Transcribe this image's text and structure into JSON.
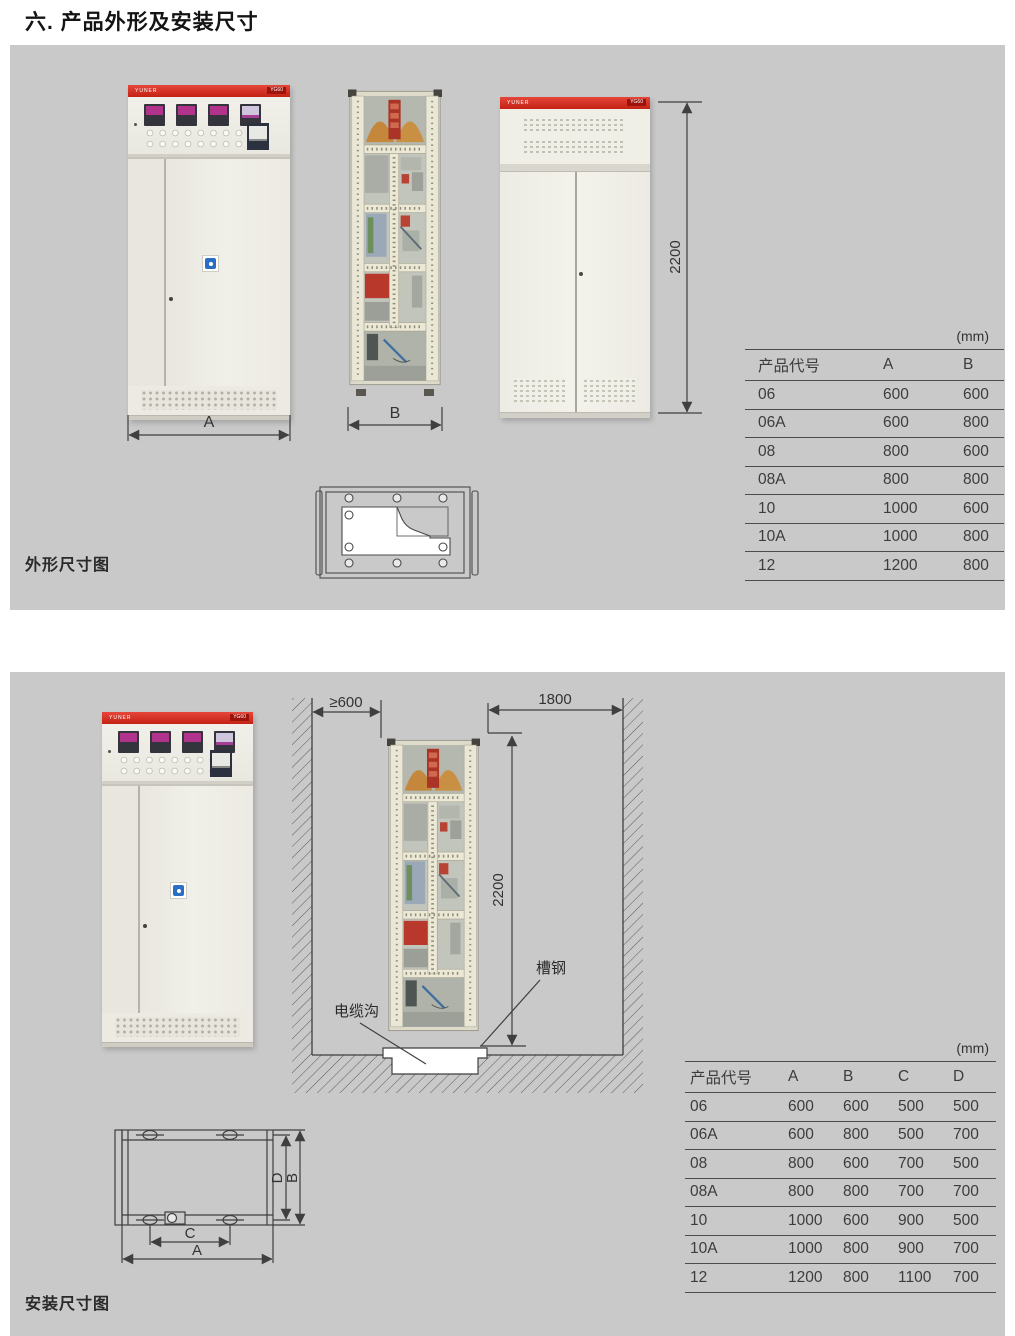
{
  "page_title": "六. 产品外形及安装尺寸",
  "brand": {
    "name": "YUNER",
    "model": "YG60"
  },
  "outline_section": {
    "caption": "外形尺寸图",
    "unit_label": "(mm)",
    "dim_width_front": "A",
    "dim_width_side": "B",
    "dim_height": "2200",
    "table": {
      "columns": [
        "产品代号",
        "A",
        "B"
      ],
      "rows": [
        [
          "06",
          "600",
          "600"
        ],
        [
          "06A",
          "600",
          "800"
        ],
        [
          "08",
          "800",
          "600"
        ],
        [
          "08A",
          "800",
          "800"
        ],
        [
          "10",
          "1000",
          "600"
        ],
        [
          "10A",
          "1000",
          "800"
        ],
        [
          "12",
          "1200",
          "800"
        ]
      ]
    }
  },
  "install_section": {
    "caption": "安装尺寸图",
    "unit_label": "(mm)",
    "dim_left_clearance": "≥600",
    "dim_right_clearance": "1800",
    "dim_height": "2200",
    "label_channel_steel": "槽钢",
    "label_cable_trench": "电缆沟",
    "plan_dims": {
      "a": "A",
      "b": "B",
      "c": "C",
      "d": "D"
    },
    "table": {
      "columns": [
        "产品代号",
        "A",
        "B",
        "C",
        "D"
      ],
      "rows": [
        [
          "06",
          "600",
          "600",
          "500",
          "500"
        ],
        [
          "06A",
          "600",
          "800",
          "500",
          "700"
        ],
        [
          "08",
          "800",
          "600",
          "700",
          "500"
        ],
        [
          "08A",
          "800",
          "800",
          "700",
          "700"
        ],
        [
          "10",
          "1000",
          "600",
          "900",
          "500"
        ],
        [
          "10A",
          "1000",
          "800",
          "900",
          "700"
        ],
        [
          "12",
          "1200",
          "800",
          "1100",
          "700"
        ]
      ]
    }
  }
}
